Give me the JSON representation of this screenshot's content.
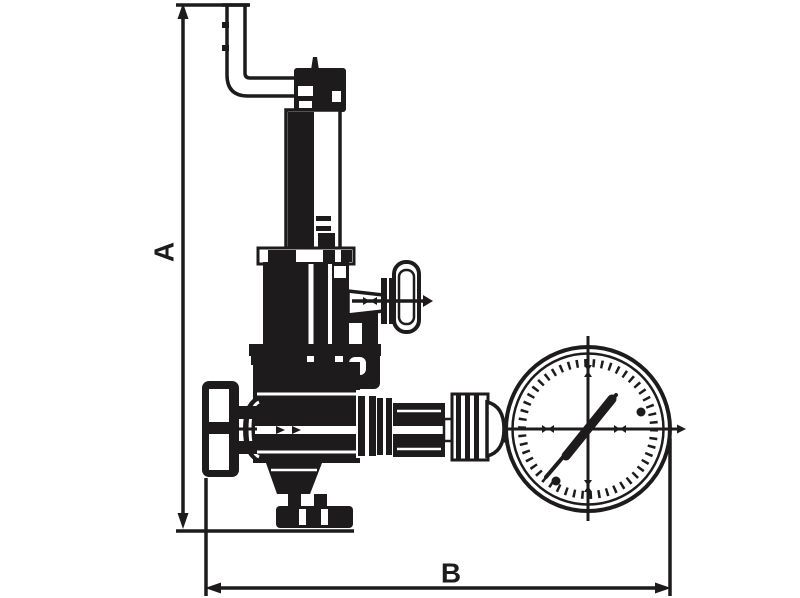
{
  "drawing": {
    "type": "technical-line-drawing",
    "description": "Dimensioned outline drawing of a pressure reducing / relief valve assembly: vertical spring bonnet with vent elbow pipe on top, side tee-handle, left handwheel on inlet, bottom outlet flange, and a pressure gauge connected on the right",
    "dimensions": {
      "vertical_label": "A",
      "horizontal_label": "B"
    },
    "colors": {
      "ink": "#1d1b1c",
      "paper": "#ffffff"
    },
    "parts": [
      "vent-elbow-pipe",
      "adjuster-cap",
      "spring-housing",
      "tee-handle",
      "valve-body",
      "handwheel",
      "outlet-flange",
      "gauge-fitting",
      "pressure-gauge"
    ]
  }
}
